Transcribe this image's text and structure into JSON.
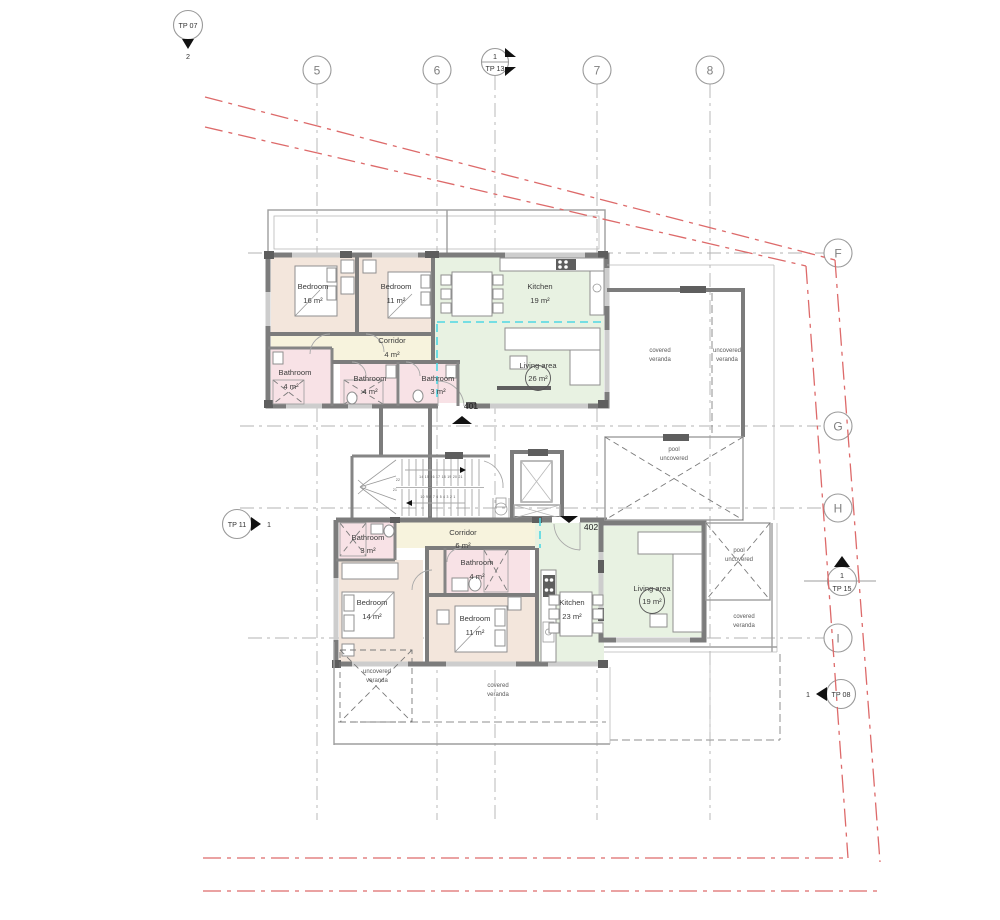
{
  "grid": {
    "col5": "5",
    "col6": "6",
    "col7": "7",
    "col8": "8",
    "rowF": "F",
    "rowG": "G",
    "rowH": "H",
    "rowI": "I"
  },
  "markers": {
    "tp07": {
      "name": "TP 07",
      "num": "2"
    },
    "tp13": {
      "name": "TP 13",
      "num": "1"
    },
    "tp11": {
      "name": "TP 11",
      "num": "1"
    },
    "tp15": {
      "name": "TP 15",
      "num": "1"
    },
    "tp08": {
      "name": "TP 08",
      "num": "1"
    }
  },
  "apartments": {
    "a401": {
      "number": "401",
      "bedroom1": {
        "name": "Bedroom",
        "area": "16 m²"
      },
      "bedroom2": {
        "name": "Bedroom",
        "area": "11 m²"
      },
      "kitchen": {
        "name": "Kitchen",
        "area": "19 m²"
      },
      "living": {
        "name": "Living area",
        "area": "26 m²"
      },
      "corridor": {
        "name": "Corridor",
        "area": "4 m²"
      },
      "bathroom1": {
        "name": "Bathroom",
        "area": "4 m²"
      },
      "bathroom2": {
        "name": "Bathroom",
        "area": "4 m²"
      },
      "bathroom3": {
        "name": "Bathroom",
        "area": "3 m²"
      }
    },
    "a402": {
      "number": "402",
      "bedroom1": {
        "name": "Bedroom",
        "area": "14 m²"
      },
      "bedroom2": {
        "name": "Bedroom",
        "area": "11 m²"
      },
      "kitchen": {
        "name": "Kitchen",
        "area": "23 m²"
      },
      "living": {
        "name": "Living area",
        "area": "19 m²"
      },
      "corridor": {
        "name": "Corridor",
        "area": "6 m²"
      },
      "bathroom1": {
        "name": "Bathroom",
        "area": "3 m²"
      },
      "bathroom2": {
        "name": "Bathroom",
        "area": "4 m²"
      }
    }
  },
  "outdoor": {
    "covered": "covered",
    "uncovered": "uncovered",
    "veranda": "veranda",
    "pool": "pool"
  },
  "stairs": {
    "flight_up": "14 15 16 17 18 19 20 21",
    "flight_down": "10 9 8 7 6 5 4 3 2 1",
    "step21": "21",
    "step22": "22"
  },
  "colors": {
    "bedroom_fill": "#f3e6dc",
    "bathroom_fill": "#f8e2e6",
    "corridor_fill": "#f7f3dd",
    "kitchen_living_fill": "#e8f2e2",
    "wall": "#7c7c7c",
    "boundary_red": "#dd6a6a",
    "section_cyan": "#4fd7e3"
  }
}
